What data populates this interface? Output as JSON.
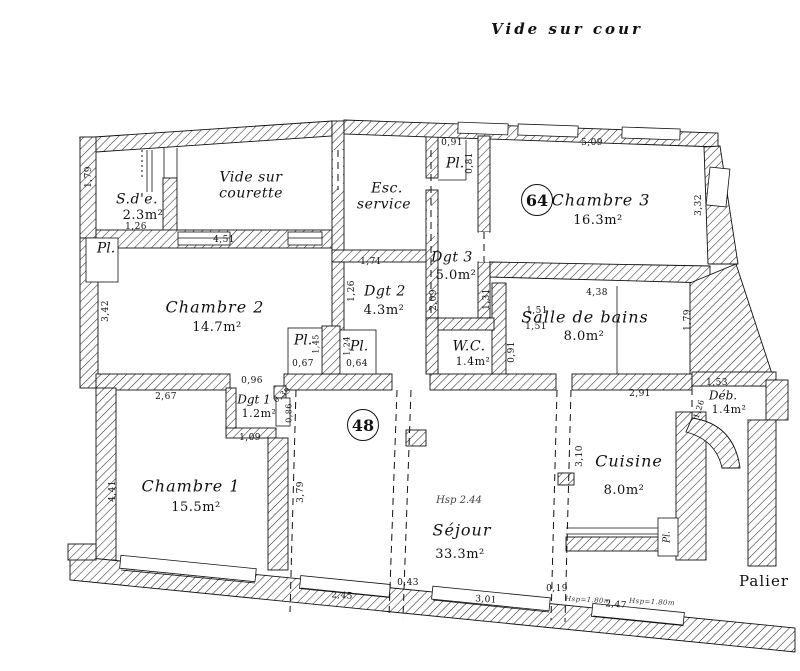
{
  "annotations": {
    "top": "Vide sur cour",
    "bottom_right": "Palier",
    "pl": "Pl.",
    "hsp_note": "Hsp 2.44"
  },
  "markers": {
    "left_unit": "48",
    "right_unit": "64"
  },
  "rooms": {
    "sde": {
      "name": "S.d'e.",
      "area": "2.3m²"
    },
    "courette": {
      "name_line1": "Vide sur",
      "name_line2": "courette"
    },
    "esc": {
      "name_line1": "Esc.",
      "name_line2": "service"
    },
    "chambre3": {
      "name": "Chambre 3",
      "area": "16.3m²"
    },
    "dgt3": {
      "name": "Dgt 3",
      "area": "5.0m²"
    },
    "dgt2": {
      "name": "Dgt 2",
      "area": "4.3m²"
    },
    "chambre2": {
      "name": "Chambre 2",
      "area": "14.7m²"
    },
    "wc": {
      "name": "W.C.",
      "area": "1.4m²"
    },
    "sdb": {
      "name": "Salle de bains",
      "area": "8.0m²"
    },
    "dgt1": {
      "name": "Dgt 1",
      "area": "1.2m²"
    },
    "chambre1": {
      "name": "Chambre 1",
      "area": "15.5m²"
    },
    "sejour": {
      "name": "Séjour",
      "area": "33.3m²"
    },
    "cuisine": {
      "name": "Cuisine",
      "area": "8.0m²"
    },
    "deb": {
      "name": "Déb.",
      "area": "1.4m²"
    }
  },
  "dimensions": [
    {
      "text": "1,79",
      "x": 89,
      "y": 177,
      "rot": -90
    },
    {
      "text": "1,26",
      "x": 136,
      "y": 227,
      "rot": 0
    },
    {
      "text": "4,51",
      "x": 224,
      "y": 240,
      "rot": 0
    },
    {
      "text": "1,71",
      "x": 371,
      "y": 262,
      "rot": 0
    },
    {
      "text": "1,26",
      "x": 352,
      "y": 291,
      "rot": -90
    },
    {
      "text": "0,91",
      "x": 452,
      "y": 143,
      "rot": 0
    },
    {
      "text": "0,81",
      "x": 470,
      "y": 163,
      "rot": -90
    },
    {
      "text": "5,09",
      "x": 592,
      "y": 143,
      "rot": 0
    },
    {
      "text": "3,32",
      "x": 699,
      "y": 205,
      "rot": -90
    },
    {
      "text": "2,09",
      "x": 434,
      "y": 300,
      "rot": -90
    },
    {
      "text": "1,31",
      "x": 487,
      "y": 299,
      "rot": -90
    },
    {
      "text": "1,51",
      "x": 537,
      "y": 311,
      "rot": 0
    },
    {
      "text": "1,51",
      "x": 536,
      "y": 327,
      "rot": 0
    },
    {
      "text": "0,91",
      "x": 512,
      "y": 352,
      "rot": -90
    },
    {
      "text": "4,38",
      "x": 597,
      "y": 293,
      "rot": 0
    },
    {
      "text": "1,79",
      "x": 688,
      "y": 320,
      "rot": -90
    },
    {
      "text": "3,42",
      "x": 106,
      "y": 311,
      "rot": -90
    },
    {
      "text": "0,67",
      "x": 303,
      "y": 364,
      "rot": 0
    },
    {
      "text": "1,45",
      "x": 316,
      "y": 344,
      "rot": -90,
      "small": true
    },
    {
      "text": "1,24",
      "x": 347,
      "y": 346,
      "rot": -90,
      "small": true
    },
    {
      "text": "0,64",
      "x": 357,
      "y": 364,
      "rot": 0
    },
    {
      "text": "0,96",
      "x": 252,
      "y": 381,
      "rot": 0
    },
    {
      "text": "2,67",
      "x": 166,
      "y": 397,
      "rot": 0
    },
    {
      "text": "1,09",
      "x": 250,
      "y": 438,
      "rot": 0
    },
    {
      "text": "0,39",
      "x": 282,
      "y": 395,
      "rot": -38,
      "small": true
    },
    {
      "text": "0,86",
      "x": 289,
      "y": 413,
      "rot": -90,
      "small": true
    },
    {
      "text": "4,41",
      "x": 113,
      "y": 491,
      "rot": -90
    },
    {
      "text": "3,79",
      "x": 301,
      "y": 492,
      "rot": -90
    },
    {
      "text": "1,53",
      "x": 717,
      "y": 383,
      "rot": 0
    },
    {
      "text": "2,91",
      "x": 640,
      "y": 394,
      "rot": 0
    },
    {
      "text": "1,26",
      "x": 699,
      "y": 409,
      "rot": -72,
      "small": true
    },
    {
      "text": "3,10",
      "x": 580,
      "y": 456,
      "rot": -90
    },
    {
      "text": "2,45",
      "x": 342,
      "y": 596,
      "rot": 4
    },
    {
      "text": "0,43",
      "x": 408,
      "y": 583,
      "rot": 0
    },
    {
      "text": "3,01",
      "x": 486,
      "y": 600,
      "rot": 4
    },
    {
      "text": "0,19",
      "x": 557,
      "y": 589,
      "rot": 0
    },
    {
      "text": "2,47",
      "x": 616,
      "y": 605,
      "rot": 4
    },
    {
      "text": "Hsp=1.80m",
      "x": 588,
      "y": 600,
      "rot": 3,
      "italic": true
    },
    {
      "text": "Hsp=1.80m",
      "x": 652,
      "y": 602,
      "rot": 3,
      "italic": true
    }
  ]
}
